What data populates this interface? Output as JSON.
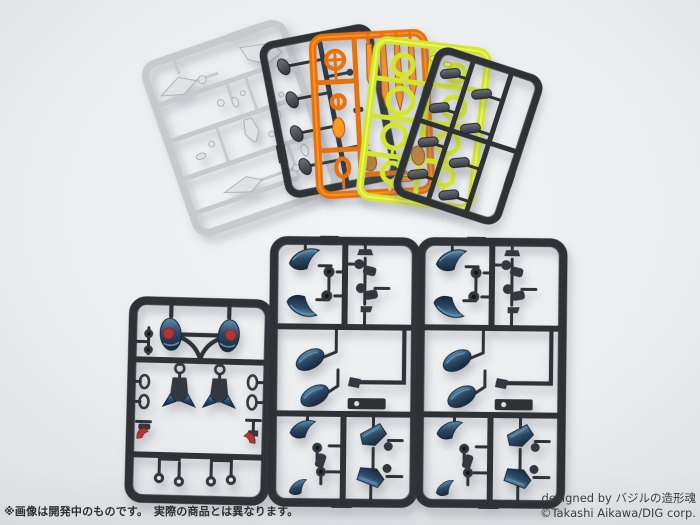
{
  "footer": {
    "disclaimer": "※画像は開発中のものです。　実際の商品とは異なります。",
    "credit_line1": "designed by バジルの造形魂",
    "credit_line2": "©Takashi Aikawa/DIG corp."
  },
  "colors": {
    "bg": "#eaecee",
    "bg-bright": "#f3f4f6",
    "bg-edge": "#dcdee2",
    "runner-gray": "#c6cacc",
    "runner-gray-dark": "#a2a7aa",
    "runner-gray-light": "#e0e3e4",
    "runner-dark": "#2f3236",
    "runner-dark-hi": "#6d727a",
    "part-dark": "#33373c",
    "clear-orange": "#e5720f",
    "clear-orange-hi": "#ff9726",
    "clear-orange-dk": "#b5560a",
    "clear-yellow": "#d3e62f",
    "clear-yellow-hi": "#ecf963",
    "clear-yellow-dk": "#a9bd17",
    "part-navy": "#2b4a67",
    "part-navy-hi": "#5e8cab",
    "part-navy-dk": "#18263a",
    "part-red": "#b23531",
    "part-copper": "#c8803b",
    "text-dark": "#2e2e2e",
    "text-credit": "#3c3c3c"
  },
  "sprues": {
    "top_row": [
      "light-gray-runner",
      "dark-gray-runner-a",
      "clear-orange-runner",
      "clear-yellow-green-runner",
      "dark-gray-runner-b"
    ],
    "bottom_row": [
      "dark-runner-navy-parts-a",
      "dark-runner-navy-parts-b",
      "dark-runner-navy-parts-c"
    ]
  }
}
